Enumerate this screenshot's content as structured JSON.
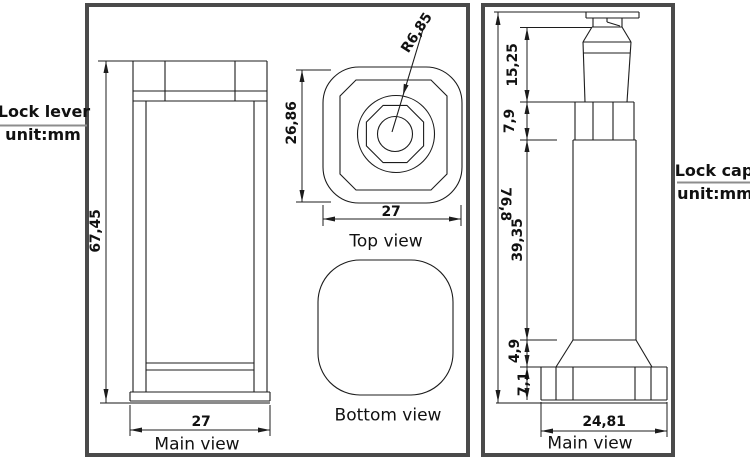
{
  "left_panel": {
    "title": "Lock lever",
    "unit": "unit:mm",
    "main_view": {
      "label": "Main view",
      "height": "67,45",
      "width": "27"
    },
    "top_view": {
      "label": "Top view",
      "height": "26,86",
      "width": "27",
      "radius": "R6,85"
    },
    "bottom_view": {
      "label": "Bottom view"
    }
  },
  "right_panel": {
    "title": "Lock cap",
    "unit": "unit:mm",
    "main_view": {
      "label": "Main view",
      "overall_height": "76,8",
      "head_height": "15,25",
      "collar_height": "7,9",
      "shaft_height": "39,35",
      "taper_height": "4,9",
      "base_height": "7,1",
      "base_width": "24,81"
    }
  },
  "colors": {
    "line": "#1c1c1c",
    "frame": "#4a4a4a",
    "background": "#ffffff"
  }
}
